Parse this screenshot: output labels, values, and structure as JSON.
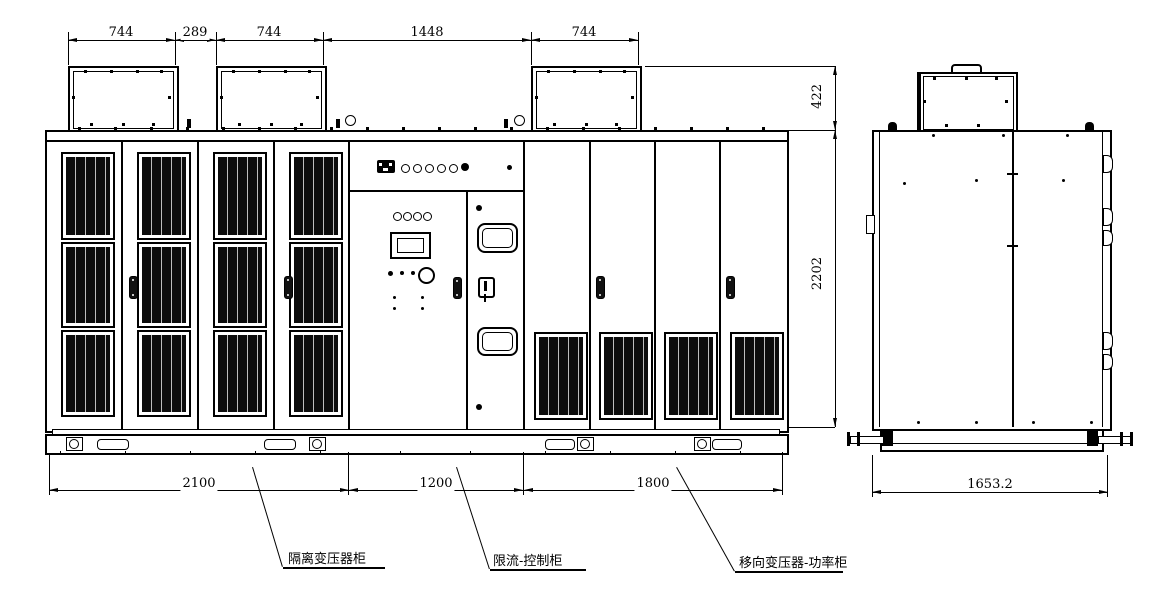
{
  "colors": {
    "line": "#000000",
    "background": "#ffffff",
    "vent_fill": "#0c0c0c"
  },
  "front_view": {
    "top_dims": [
      "744",
      "289",
      "744",
      "1448",
      "744"
    ],
    "height_dims": [
      "422",
      "2202"
    ],
    "bottom_dims": [
      "2100",
      "1200",
      "1800"
    ]
  },
  "side_view": {
    "bottom_dim": "1653.2"
  },
  "callouts": [
    "隔离变压器柜",
    "限流-控制柜",
    "移向变压器-功率柜"
  ]
}
